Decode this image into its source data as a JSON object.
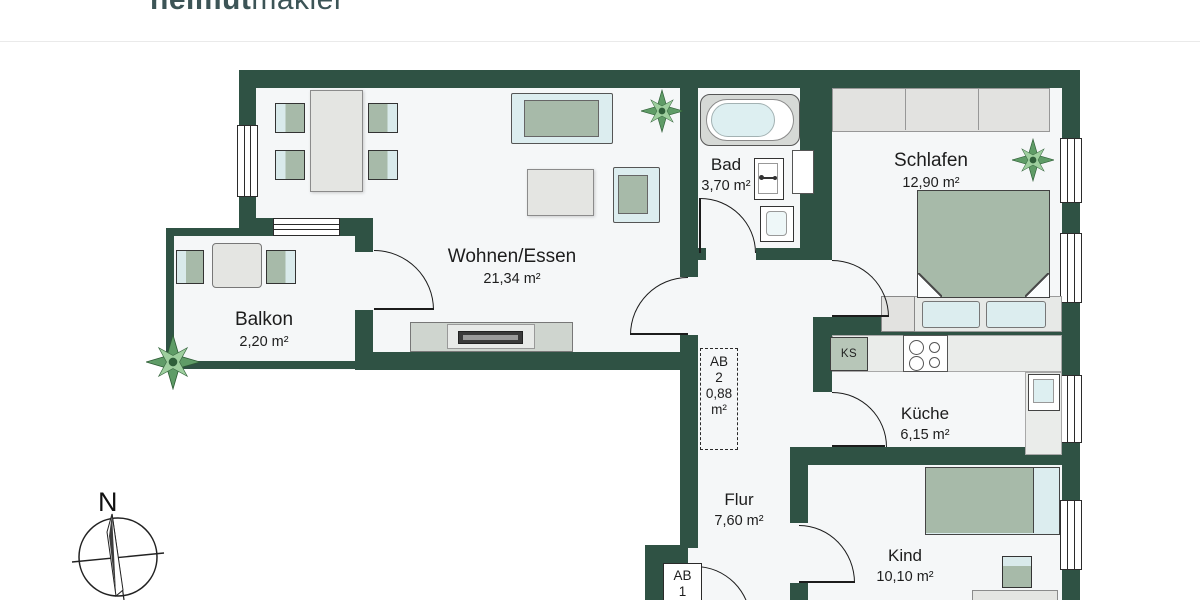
{
  "logo": {
    "bold": "helmut",
    "light": "makler"
  },
  "rooms": {
    "wohnen": {
      "name": "Wohnen/Essen",
      "area": "21,34 m²"
    },
    "balkon": {
      "name": "Balkon",
      "area": "2,20 m²"
    },
    "bad": {
      "name": "Bad",
      "area": "3,70 m²"
    },
    "schlafen": {
      "name": "Schlafen",
      "area": "12,90 m²"
    },
    "kueche": {
      "name": "Küche",
      "area": "6,15 m²"
    },
    "flur": {
      "name": "Flur",
      "area": "7,60 m²"
    },
    "kind": {
      "name": "Kind",
      "area": "10,10 m²"
    }
  },
  "storage": {
    "ab2": {
      "line1": "AB",
      "line2": "2",
      "line3": "0,88",
      "line4": "m²"
    },
    "ab1": {
      "line1": "AB",
      "line2": "1"
    }
  },
  "kitchen": {
    "fridge_label": "KS"
  },
  "compass": {
    "north_label": "N"
  },
  "colors": {
    "wall": "#2f5244",
    "floor": "#f5f7f8",
    "furniture_sage": "#a7baa9",
    "furniture_pale": "#dcedef",
    "logo": "#3c5456"
  }
}
